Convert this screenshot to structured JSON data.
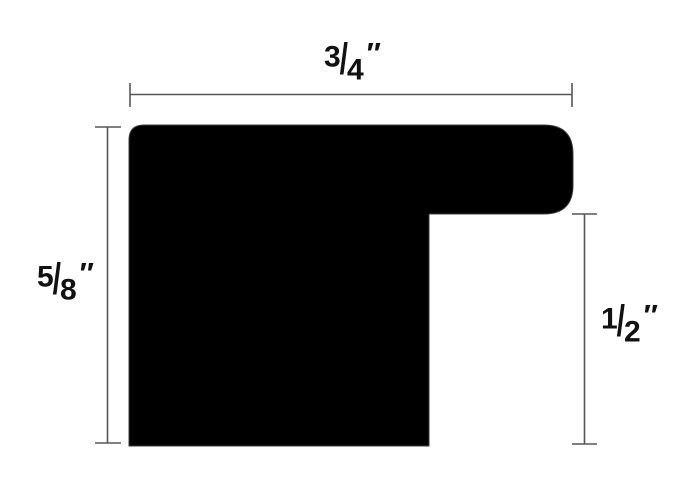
{
  "diagram": {
    "type": "moulding-profile-cross-section",
    "background_color": "#ffffff",
    "shape_color": "#000000",
    "line_color": "#565656",
    "text_color": "#111111",
    "slash": "/",
    "unit_mark": "″",
    "dimensions": {
      "top_width": {
        "label": "3/4″",
        "num": "3",
        "den": "4"
      },
      "left_height": {
        "label": "5/8″",
        "num": "5",
        "den": "8"
      },
      "right_height": {
        "label": "1/2″",
        "num": "1",
        "den": "2"
      }
    }
  }
}
